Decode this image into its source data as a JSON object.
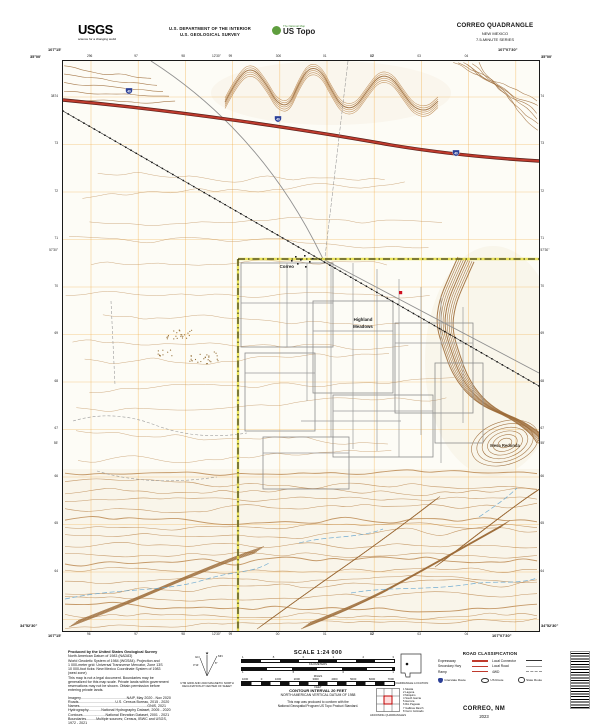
{
  "header": {
    "logo_text": "USGS",
    "logo_tagline": "science for a changing world",
    "dept_line1": "U.S. DEPARTMENT OF THE INTERIOR",
    "dept_line2": "U.S. GEOLOGICAL SURVEY",
    "ustopo_small": "The National Map",
    "ustopo_text": "US Topo",
    "quad_title": "CORREO QUADRANGLE",
    "quad_state": "NEW MEXICO",
    "quad_series": "7.5-MINUTE SERIES"
  },
  "map": {
    "labels": {
      "settlement": "Correo",
      "subdivision1": "Highland",
      "subdivision2": "Meadows",
      "mesa": "Mesa Redonda"
    },
    "shield_route": "40",
    "corners": {
      "tl_lon": "107°15'",
      "tl_lat": "35°00'",
      "tr_lon": "107°07'30\"",
      "tr_lat": "35°00'",
      "bl_lat": "34°52'30\"",
      "bl_lon": "107°15'",
      "br_lat": "34°52'30\"",
      "br_lon": "107°07'30\""
    },
    "mid_ticks": {
      "top": [
        "12'30\"",
        "10'"
      ],
      "bottom": [
        "12'30\"",
        "10'"
      ],
      "left": [
        "57'30\"",
        "55'"
      ],
      "right": [
        "57'30\"",
        "55'"
      ]
    },
    "edge_ticks": {
      "top": [
        "296",
        "97",
        "98",
        "99",
        "300",
        "01",
        "02",
        "03",
        "04"
      ],
      "bottom": [
        "96",
        "97",
        "98",
        "99",
        "00",
        "01",
        "02",
        "03",
        "04"
      ],
      "left": [
        "3874",
        "73",
        "72",
        "71",
        "70",
        "69",
        "68",
        "67",
        "66",
        "65",
        "64"
      ],
      "right": [
        "74",
        "73",
        "72",
        "71",
        "70",
        "69",
        "68",
        "67",
        "66",
        "65",
        "64"
      ]
    }
  },
  "footer": {
    "produced_lines": [
      "Produced by the United States Geological Survey",
      "North American Datum of 1983 (NAD83)",
      "World Geodetic System of 1984 (WGS84). Projection and",
      "1 000-meter grid: Universal Transverse Mercator, Zone 13S",
      "10 000-foot ticks: New Mexico Coordinate System of 1983",
      "(west zone)",
      "This map is not a legal document. Boundaries may be",
      "generalized for this map scale. Private lands within government",
      "reservations may not be shown. Obtain permission before",
      "entering private lands."
    ],
    "credit_lines": [
      "Imagery..............................................NAIP, May 2020 - Nov 2020",
      "Roads.....................................U.S. Census Bureau, 2015 - 2020",
      "Names....................................................................GNIS, 2021",
      "Hydrography.............National Hydrography Dataset, 2005 - 2020",
      "Contours.......................National Elevation Dataset, 2001 - 2021",
      "Boundaries..........Multiple sources; Census, IBWC and USGS,",
      "1972 - 2021",
      "Wetlands.............FWS National Wetlands Inventory, 1977 - 2014"
    ],
    "declination": {
      "gn_label": "GN",
      "mn_label": "MN",
      "gn_value": "0°14'",
      "mn_value": "8°",
      "caption1": "UTM GRID AND 2023 MAGNETIC NORTH",
      "caption2": "DECLINATION AT CENTER OF SHEET"
    },
    "scale": {
      "title": "SCALE 1:24 000",
      "km_numbers": [
        "1",
        ".5",
        "0",
        "1",
        "2",
        "3"
      ],
      "km_label": "KILOMETERS",
      "mi_numbers": [
        "1",
        ".5",
        "0",
        "1"
      ],
      "mi_label": "MILES",
      "ft_numbers": [
        "1000",
        "0",
        "1000",
        "2000",
        "3000",
        "4000",
        "5000",
        "6000",
        "7000"
      ],
      "ft_label": "FEET",
      "contour1": "CONTOUR INTERVAL 20 FEET",
      "contour2": "NORTH AMERICAN VERTICAL DATUM OF 1988",
      "conform1": "This map was produced to conform with the",
      "conform2": "National Geospatial Program US Topo Product Standard."
    },
    "locator": {
      "caption": "QUADRANGLE LOCATION"
    },
    "adjoining": {
      "caption": "ADJOINING QUADRANGLES",
      "names": [
        "Mesita",
        "Laguna",
        "Moquino",
        "South Garcia",
        "Herrera",
        "Rio Paguate",
        "Gallinas Ranch",
        "Cerro Colorado"
      ]
    },
    "road_legend": {
      "title": "ROAD CLASSIFICATION",
      "left_rows": [
        "Expressway",
        "Secondary Hwy",
        "Ramp"
      ],
      "right_rows": [
        "Local Connector",
        "Local Road",
        "4WD"
      ],
      "shield_rows": [
        "Interstate Route",
        "US Route",
        "State Route"
      ]
    },
    "imprint": {
      "title": "CORREO, NM",
      "year": "2023"
    }
  },
  "colors": {
    "contour": "#bc8a52",
    "contour_dense": "#9c6b38",
    "highway": "#bf3a2d",
    "highway_casing": "#57201a",
    "grid": "#f0a73a",
    "water": "#69a8d0",
    "boundary_yellow": "#e3dc35",
    "road_gray": "#9a9a9a",
    "shield_blue": "#2b3f97",
    "building_red": "#cf1020"
  }
}
